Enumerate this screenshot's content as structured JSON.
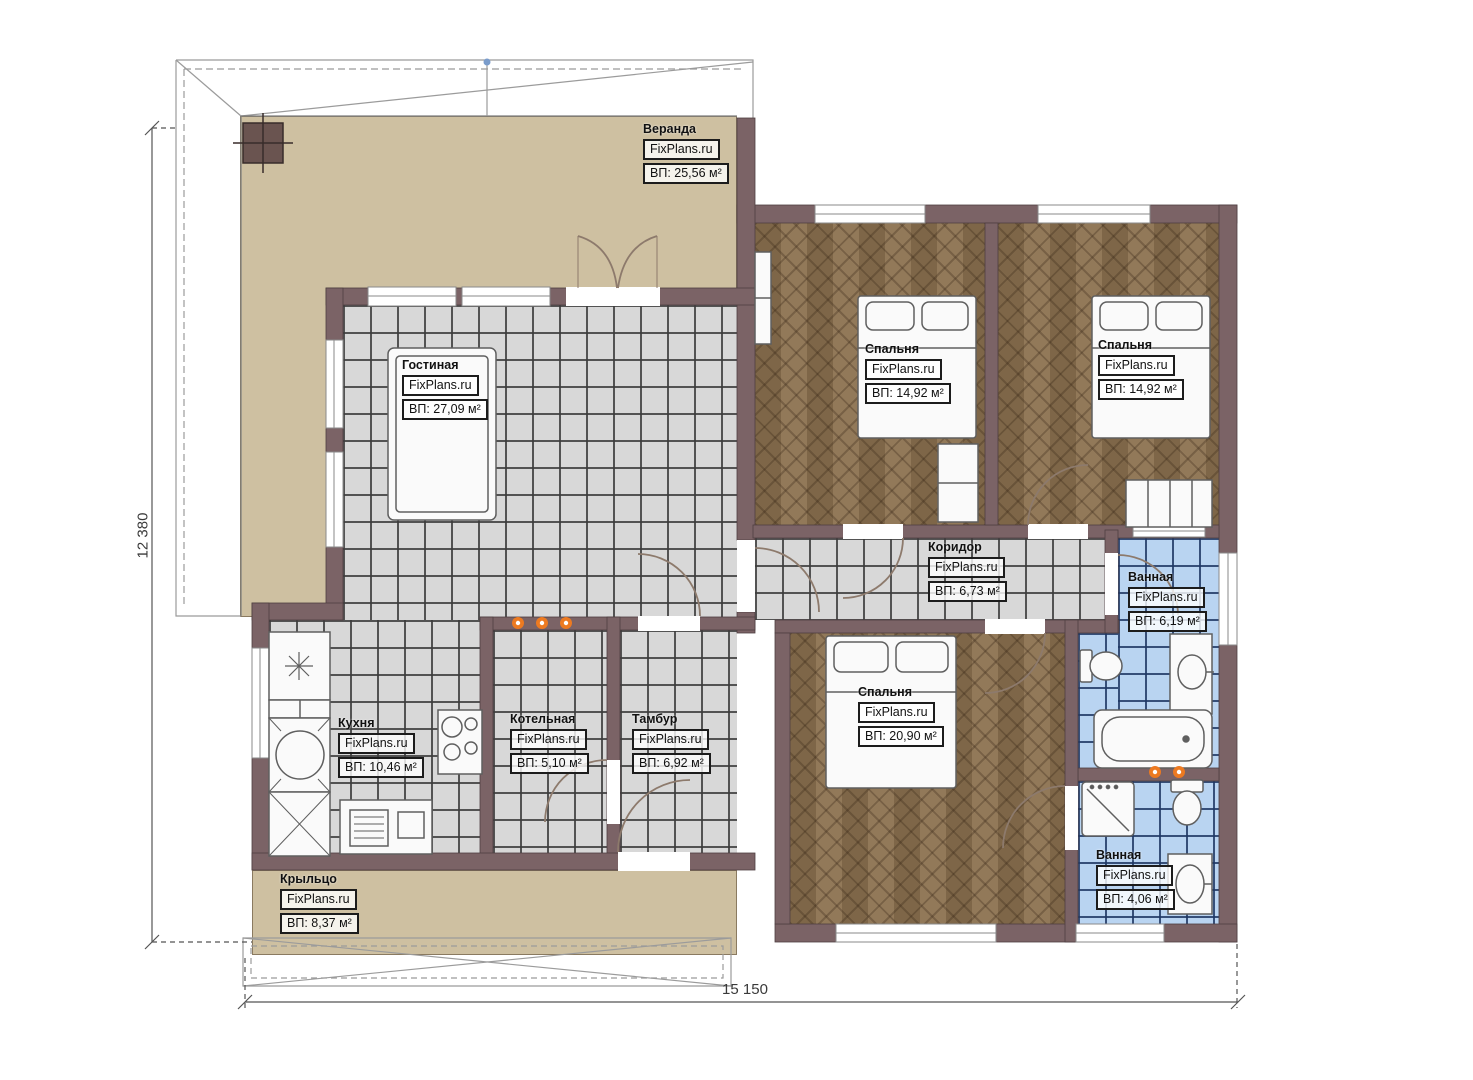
{
  "watermark": "FixPlans.ru",
  "dimensions": {
    "height_mm": "12 380",
    "width_mm": "15 150"
  },
  "rooms": [
    {
      "key": "veranda",
      "name": "Веранда",
      "area": "ВП: 25,56 м²"
    },
    {
      "key": "living",
      "name": "Гостиная",
      "area": "ВП: 27,09 м²"
    },
    {
      "key": "bedroom-1",
      "name": "Спальня",
      "area": "ВП: 14,92 м²"
    },
    {
      "key": "bedroom-2",
      "name": "Спальня",
      "area": "ВП: 14,92 м²"
    },
    {
      "key": "corridor",
      "name": "Коридор",
      "area": "ВП: 6,73 м²"
    },
    {
      "key": "bathroom-1",
      "name": "Ванная",
      "area": "ВП: 6,19 м²"
    },
    {
      "key": "kitchen",
      "name": "Кухня",
      "area": "ВП: 10,46 м²"
    },
    {
      "key": "boiler",
      "name": "Котельная",
      "area": "ВП: 5,10 м²"
    },
    {
      "key": "vestibule",
      "name": "Тамбур",
      "area": "ВП: 6,92 м²"
    },
    {
      "key": "bedroom-3",
      "name": "Спальня",
      "area": "ВП: 20,90 м²"
    },
    {
      "key": "bathroom-2",
      "name": "Ванная",
      "area": "ВП: 4,06 м²"
    },
    {
      "key": "porch",
      "name": "Крыльцо",
      "area": "ВП: 8,37 м²"
    }
  ],
  "colors": {
    "wall": "#7b6366",
    "veranda_floor": "#cec0a1",
    "tile_grey": "#d8d8d8",
    "tile_blue": "#b9d4f1",
    "wood": "#8c7250",
    "radiator": "#ed7a21"
  }
}
